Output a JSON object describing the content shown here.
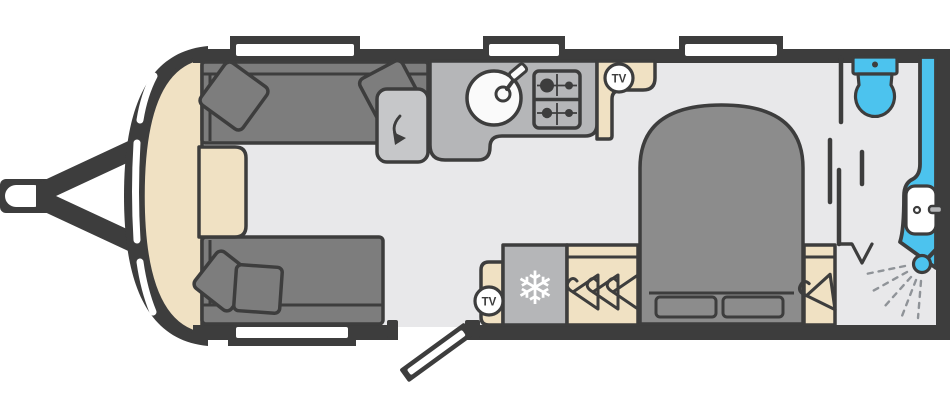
{
  "diagram": {
    "type": "caravan-floorplan",
    "badges": {
      "tv_kitchen": "TV",
      "tv_lounge": "TV"
    },
    "icons": {
      "fridge_glyph": "❄"
    },
    "colors": {
      "wall": "#3d3d3d",
      "floor": "#e8e8ea",
      "cream": "#f0e1c3",
      "sofa": "#7d7d7d",
      "bed": "#8c8c8c",
      "counter": "#b5b6b8",
      "counter_light": "#c6c7c9",
      "blue": "#4cc3ee",
      "white": "#ffffff",
      "spray": "#8f9398"
    },
    "features": [
      "tow-hitch",
      "front-windows",
      "lounge-sofas",
      "occasional-chest",
      "swivel-unit",
      "kitchen-sink",
      "hob",
      "tv-point-kitchen",
      "entry-door",
      "tv-point-lounge",
      "fridge",
      "wardrobe",
      "island-bed",
      "bedside-wardrobe",
      "washroom",
      "toilet",
      "washbasin",
      "shower"
    ]
  }
}
